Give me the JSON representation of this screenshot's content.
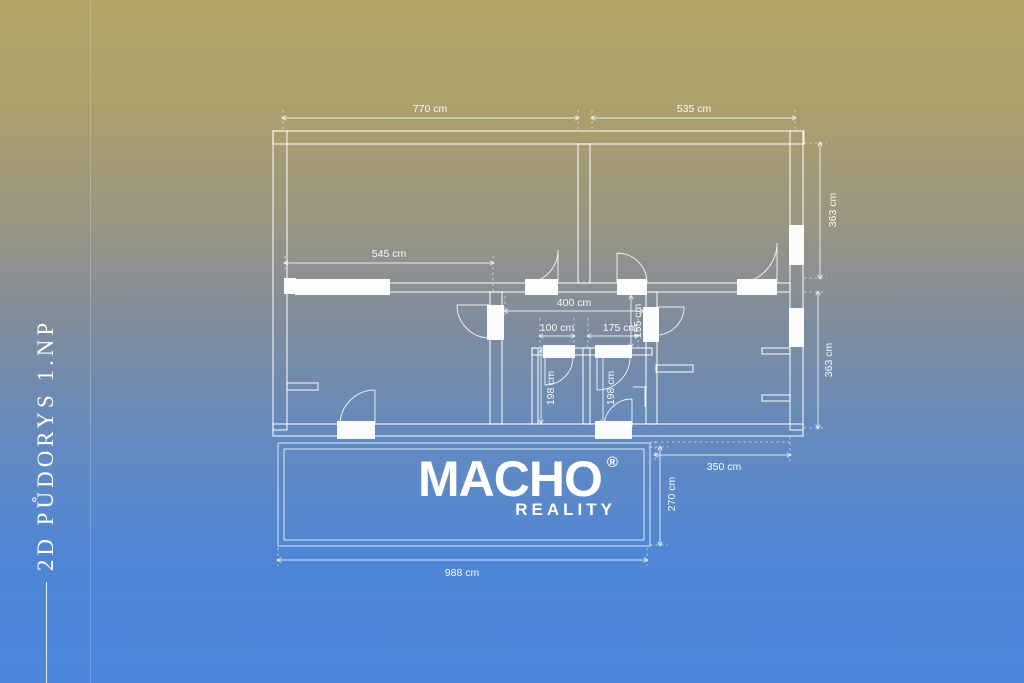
{
  "sidebar": {
    "title": "2D PŮDORYS 1.NP"
  },
  "logo": {
    "brand": "MACHO",
    "registered": "®",
    "tagline": "REALITY"
  },
  "floor_plan": {
    "unit": "cm",
    "dimensions": {
      "top_left_width": "770 cm",
      "top_right_width": "535 cm",
      "living_room_width": "545 cm",
      "hall_width": "400 cm",
      "hall_left_width": "100 cm",
      "hall_right_width": "175 cm",
      "hall_depth": "155 cm",
      "bath_left_depth": "198 cm",
      "bath_right_depth": "198 cm",
      "right_upper_height": "363 cm",
      "right_lower_height": "363 cm",
      "patio_width": "350 cm",
      "patio_depth": "270 cm",
      "total_width": "988 cm"
    }
  },
  "colors": {
    "background_top": "#b3a565",
    "background_bottom": "#4a87dc",
    "line": "#ffffff"
  }
}
